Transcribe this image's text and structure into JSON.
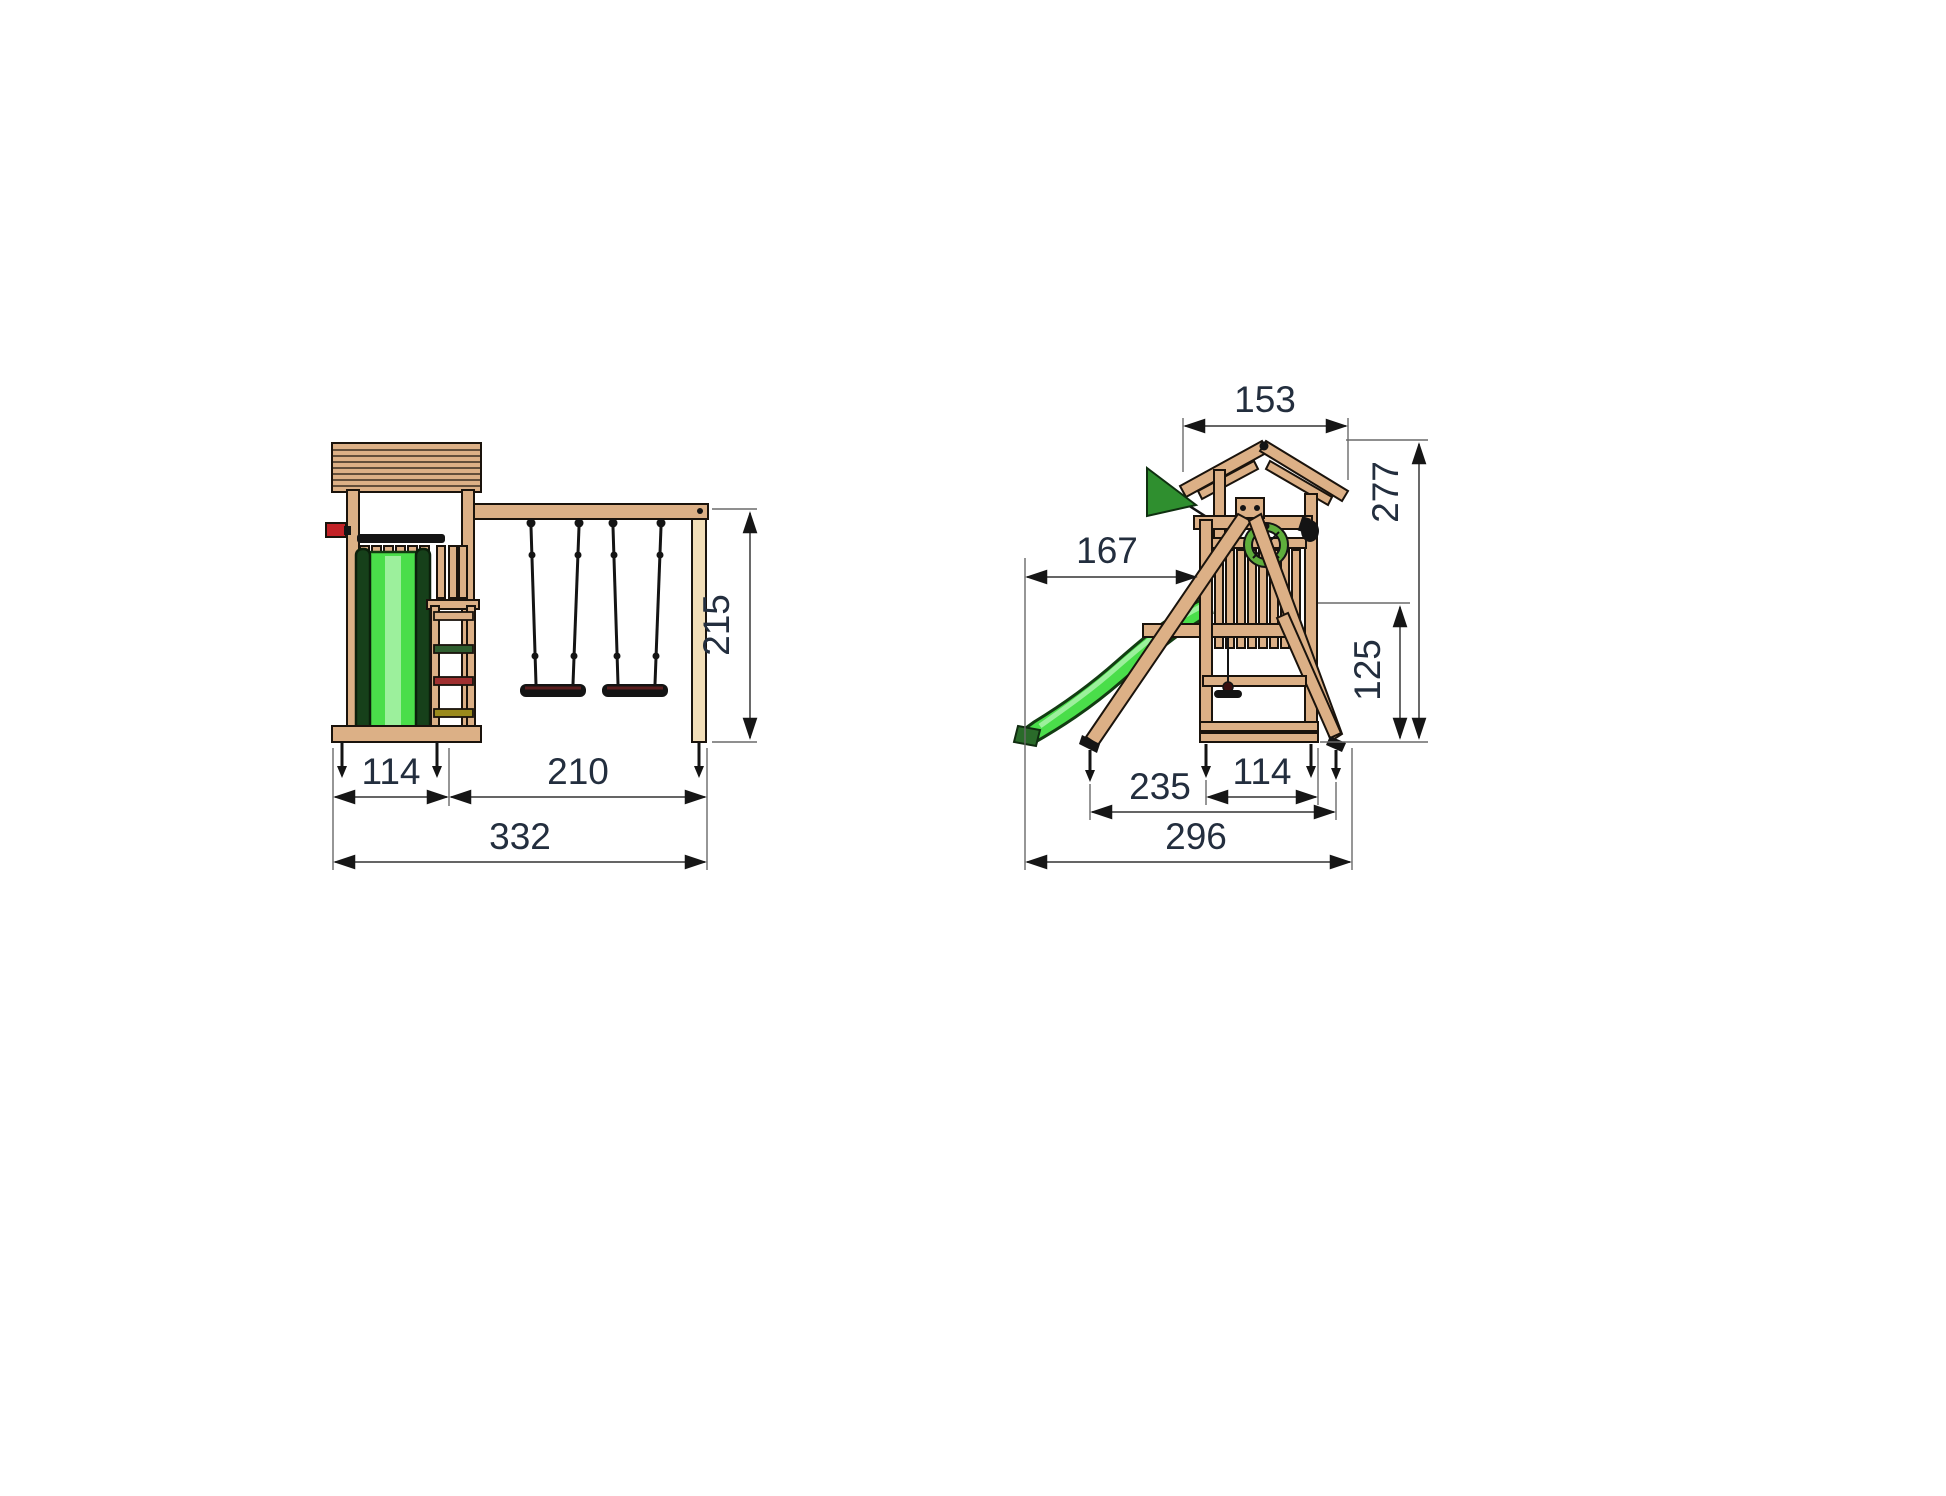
{
  "drawing": {
    "title": "playground-tower-swing-dimension-drawing",
    "background": "#FFFFFF"
  },
  "front_view": {
    "label": "front-elevation",
    "dim_height": "215",
    "dim_tower_width": "114",
    "dim_swing_width": "210",
    "dim_total_width": "332"
  },
  "side_view": {
    "label": "side-elevation",
    "dim_roof_width": "153",
    "dim_total_height": "277",
    "dim_slide_reach": "167",
    "dim_platform_height": "125",
    "dim_frame_depth": "235",
    "dim_tower_depth": "114",
    "dim_total_depth": "296"
  },
  "colors": {
    "wood": "#DCB086",
    "wood_light": "#F2DEB8",
    "outline": "#1A130C",
    "slide_green": "#4ADE4A",
    "slide_highlight": "#9CF09C",
    "slide_rail_green": "#16401A",
    "flag_green": "#2F8F2F",
    "accent_red": "#C22126",
    "rung_green": "#2F5E2F",
    "rung_red": "#A03030",
    "rung_olive": "#9A8A1C",
    "wheel_green": "#5FAE3C",
    "wheel_hub_yellow": "#D9D93A",
    "dimension_text": "#232E3E",
    "dimension_line": "#4F4F4F"
  }
}
